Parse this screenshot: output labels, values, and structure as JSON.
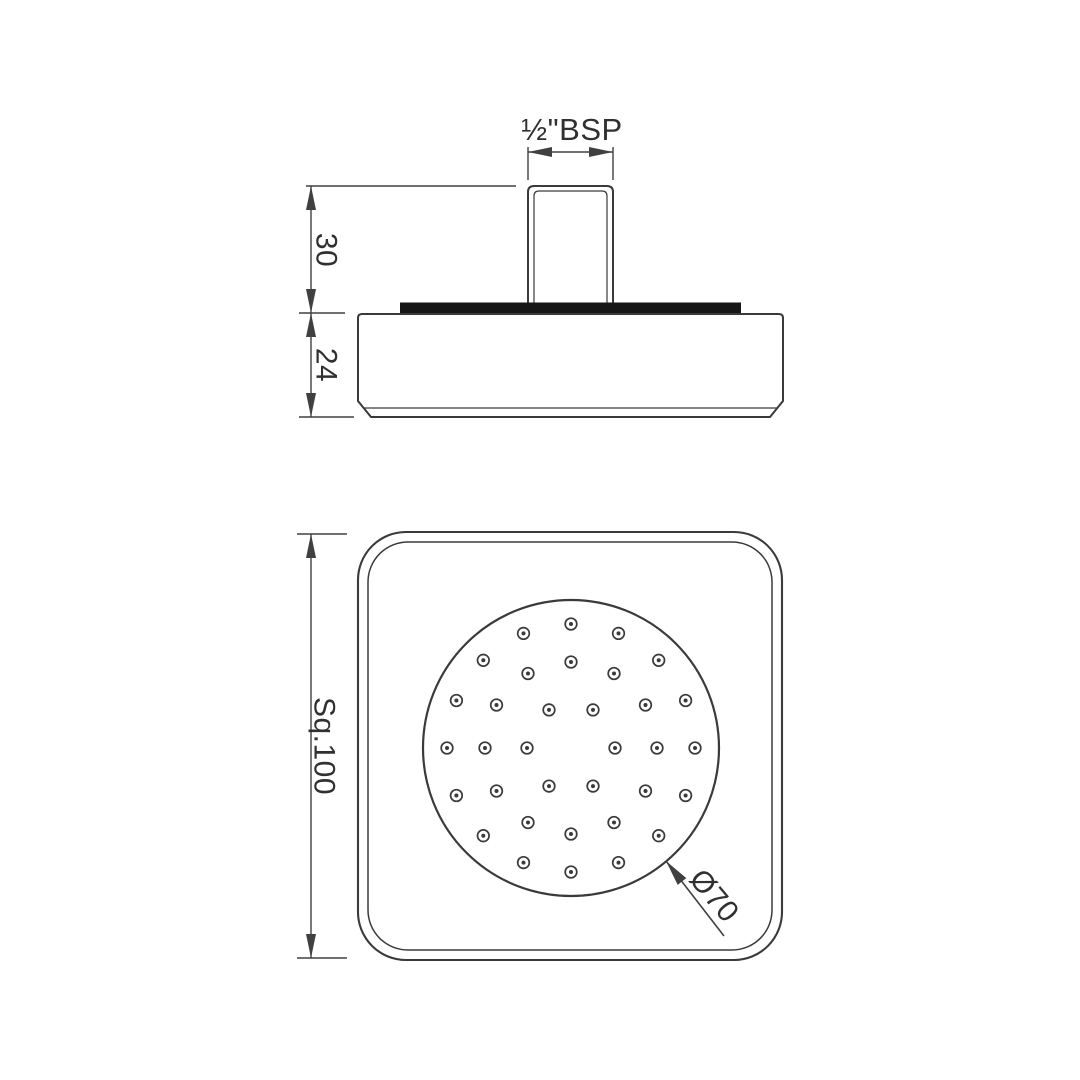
{
  "drawing": {
    "kind": "technical-dimension-drawing",
    "subject": "square overhead shower, side elevation and spray-face view"
  },
  "colors": {
    "background": "#ffffff",
    "line": "#3a3a3a",
    "dim": "#404040",
    "plate_fill": "#161616",
    "text": "#303030"
  },
  "labels": {
    "thread": "½\"BSP",
    "inlet_height": "30",
    "body_height": "24",
    "square_size": "Sq.100",
    "face_diameter": "Ø70"
  },
  "dimensions": {
    "thread_size": "1/2\" BSP",
    "inlet_height_mm": 30,
    "body_height_mm": 24,
    "square_size_mm": 100,
    "face_diameter_mm": 70
  },
  "bottom_view": {
    "face_circle": {
      "cx": 571,
      "cy": 748,
      "r": 148
    },
    "nozzle_style": {
      "outer_r": 5.8,
      "outer_stroke": 1.7,
      "dot_r": 2.0
    },
    "nozzle_rings": [
      {
        "count": 6,
        "radius": 44,
        "start_angle": 0
      },
      {
        "count": 12,
        "radius": 86,
        "start_angle": 0
      },
      {
        "count": 16,
        "radius": 124,
        "start_angle": 0
      }
    ],
    "nozzle_total": 34
  }
}
